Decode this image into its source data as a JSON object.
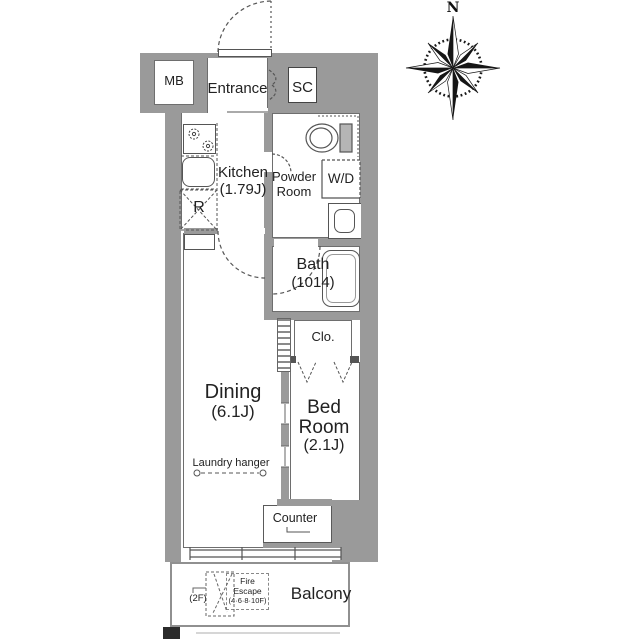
{
  "colors": {
    "wall": "#9a9a9a",
    "line": "#555555",
    "text": "#222222"
  },
  "compass": {
    "north": "N"
  },
  "labels": {
    "north": "N",
    "mb": "MB",
    "entrance": "Entrance",
    "sc": "SC",
    "kitchen_name": "Kitchen",
    "kitchen_size": "(1.79J)",
    "powder_1": "Powder",
    "powder_2": "Room",
    "wd": "W/D",
    "fridge": "R",
    "bath_name": "Bath",
    "bath_size": "(1014)",
    "closet": "Clo.",
    "dining_name": "Dining",
    "dining_size": "(6.1J)",
    "bed_1": "Bed",
    "bed_2": "Room",
    "bed_size": "(2.1J)",
    "laundry": "Laundry hanger",
    "counter": "Counter",
    "balcony": "Balcony",
    "fire_1": "Fire",
    "fire_2": "Escape",
    "fire_3": "(4·6·8·10F)",
    "fire_2f": "(2F)"
  }
}
